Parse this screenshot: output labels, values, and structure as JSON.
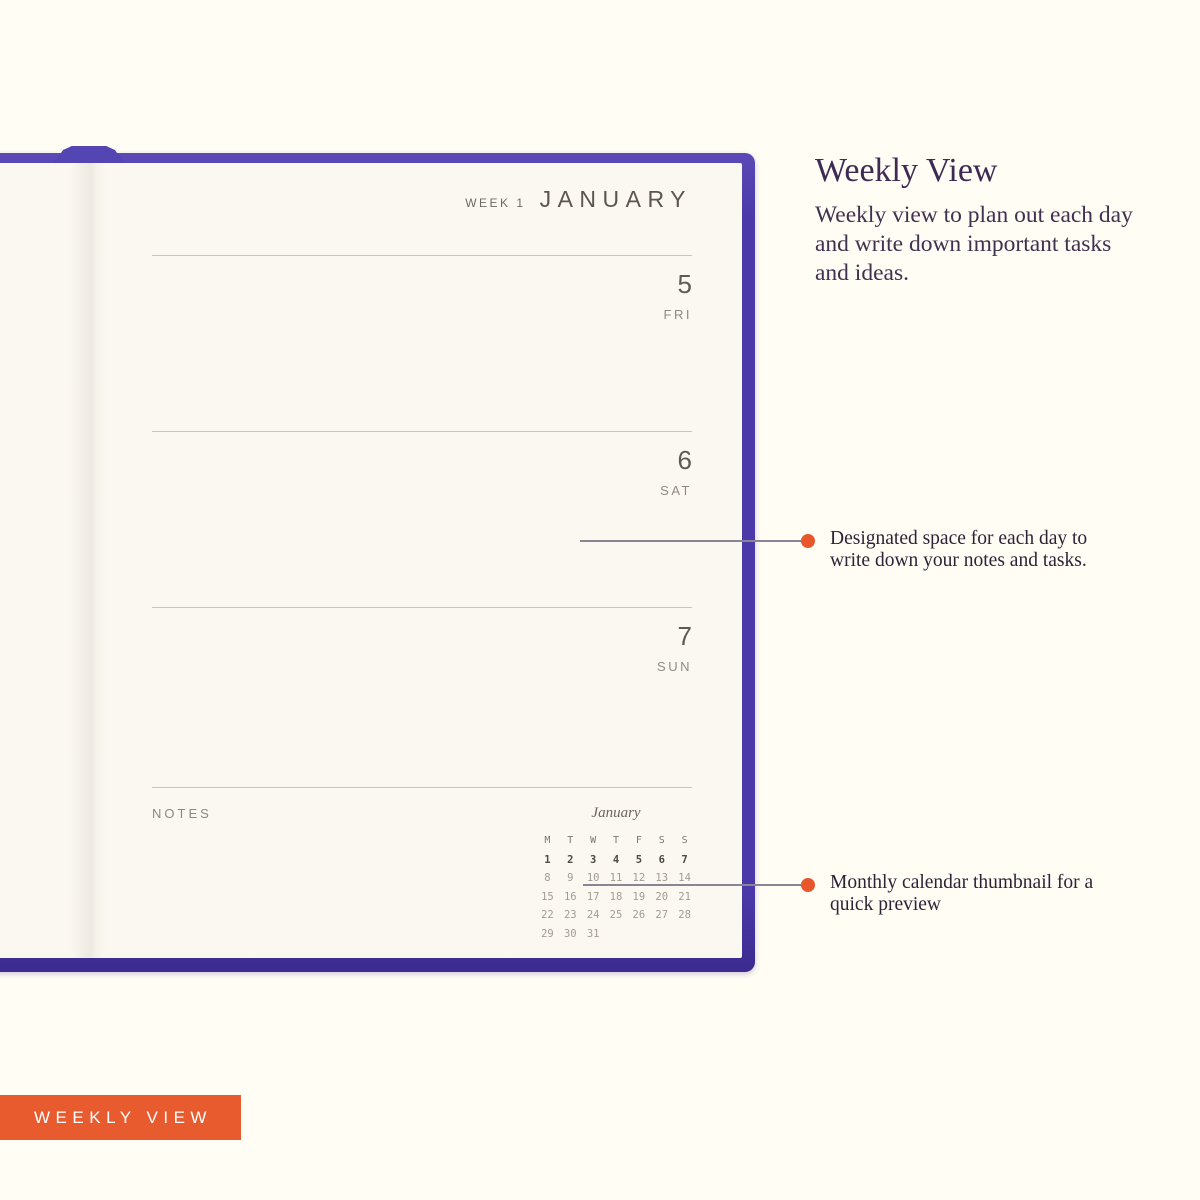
{
  "colors": {
    "background": "#fffdf4",
    "cover_purple": "#4b39a9",
    "page_cream": "#fbf8f1",
    "accent_orange": "#e8562c",
    "badge_orange": "#e85b2e",
    "heading_purple": "#3e2a54",
    "callout_line_gray": "#8b8494"
  },
  "planner": {
    "header": {
      "week_label": "WEEK 1",
      "month_title": "JANUARY"
    },
    "days": [
      {
        "date": "5",
        "weekday": "FRI"
      },
      {
        "date": "6",
        "weekday": "SAT"
      },
      {
        "date": "7",
        "weekday": "SUN"
      }
    ],
    "notes_label": "NOTES",
    "mini_calendar": {
      "month": "January",
      "weekday_headers": [
        "M",
        "T",
        "W",
        "T",
        "F",
        "S",
        "S"
      ],
      "weeks": [
        [
          "1",
          "2",
          "3",
          "4",
          "5",
          "6",
          "7"
        ],
        [
          "8",
          "9",
          "10",
          "11",
          "12",
          "13",
          "14"
        ],
        [
          "15",
          "16",
          "17",
          "18",
          "19",
          "20",
          "21"
        ],
        [
          "22",
          "23",
          "24",
          "25",
          "26",
          "27",
          "28"
        ],
        [
          "29",
          "30",
          "31",
          "",
          "",
          "",
          ""
        ]
      ],
      "current_week_row": 0
    }
  },
  "info": {
    "title": "Weekly View",
    "description": "Weekly view to plan out each day and write down important tasks and ideas."
  },
  "annotations": [
    {
      "text": "Designated space for each day to write down your notes and tasks."
    },
    {
      "text": "Monthly calendar thumbnail for a quick preview"
    }
  ],
  "badge": {
    "label": "WEEKLY VIEW"
  }
}
